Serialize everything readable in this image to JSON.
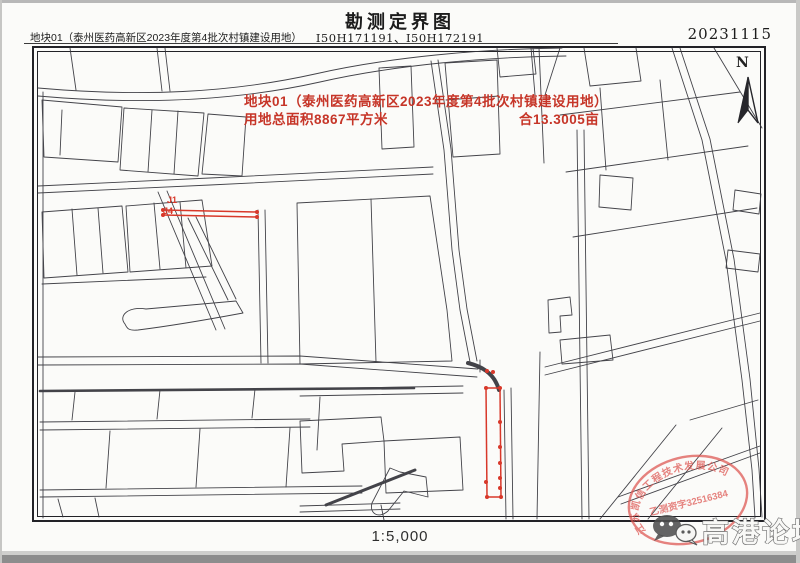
{
  "page": {
    "title": "勘测定界图",
    "header_left": "地块01（泰州医药高新区2023年度第4批次村镇建设用地）",
    "sheet_codes": "I50H171191、I50H172191",
    "date": "20231115",
    "scale": "1:5,000",
    "north_label": "N"
  },
  "annotation": {
    "line1": "地块01（泰州医药高新区2023年度第4批次村镇建设用地）",
    "line2a": "用地总面积8867平方米",
    "line2b": "合13.3005亩"
  },
  "point_labels": {
    "j1": "J1",
    "j4": "J4"
  },
  "stamp": {
    "arc_text": "江苏凯信工程技术发展公司",
    "center_text": "乙测资字32516384"
  },
  "watermark": {
    "text": "高港论坛"
  },
  "colors": {
    "line": "#34343b",
    "red": "#d8382a",
    "annotation_red": "#c63528",
    "seal_red": "#dd5450",
    "watermark_gray": "#707070"
  },
  "map_geometry": {
    "parcel_paths": [
      "M38,88 C140,97 230,93 315,74 C390,57 480,49 562,48",
      "M38,96 C140,105 235,101 320,82 C395,65 485,57 566,56",
      "M157,48 L162,91",
      "M165,48 L170,91",
      "M70,48 L76,90",
      "M431,61 L444,150 L452,250 L460,310 L470,362",
      "M438,60 L451,149 L459,250 L467,309 L477,361",
      "M497,48 L500,77 L536,74 L533,48",
      "M531,48 L535,95",
      "M539,48 L544,163",
      "M672,48 L702,140 L726,260 L742,380 L752,470 L755,518",
      "M680,48 L710,139 L734,259 L750,379 L759,469 L762,517",
      "M584,48 L590,86 L641,81 L636,48",
      "M560,115 L740,92",
      "M566,172 L748,146",
      "M573,237 L757,208",
      "M600,88 L606,170",
      "M660,80 L668,160",
      "M714,48 L762,128",
      "M735,190 L761,194 L759,214 L733,210 Z",
      "M728,250 L760,254 L758,272 L726,268 Z",
      "M38,186 L210,178 L433,167",
      "M38,193 L210,185 L433,174",
      "M42,100 L122,107 L118,162 L44,157 Z",
      "M62,110 L60,155",
      "M124,108 L204,113 L198,176 L120,170 Z",
      "M152,110 L148,172",
      "M178,111 L174,174",
      "M208,114 L246,117 L242,176 L202,174 Z",
      "M42,212 L122,206 L128,272 L44,278 Z",
      "M72,209 L77,275",
      "M98,208 L103,273",
      "M126,206 L202,200 L212,266 L130,272 Z",
      "M154,203 L160,269",
      "M180,202 L186,268",
      "M158,192 L216,330",
      "M167,191 L225,329",
      "M188,218 L228,300",
      "M196,217 L236,299",
      "M125,324 C118,316 128,306 146,309 L236,301 L243,313 C200,321 162,327 138,330 C128,331 127,328 125,324 Z",
      "M42,284 L206,277",
      "M258,210 L261,363",
      "M265,210 L268,363",
      "M297,203 L430,196 L447,310 L452,361 L300,364 Z",
      "M371,199 L376,362",
      "M379,68 L411,66 L414,147 L382,149 Z",
      "M445,63 L497,60 L500,154 L453,157 Z",
      "M446,100 L499,96",
      "M38,357 L300,356 L478,369",
      "M38,365 L300,364 L477,377",
      {
        "d": "M40,391 L414,388",
        "w": 2.6
      },
      "M40,422 L310,419",
      "M40,430 L310,427",
      "M75,392 L72,420",
      "M160,390 L157,419",
      "M255,389 L252,418",
      "M110,431 L106,488",
      "M200,429 L196,487",
      "M290,428 L286,487",
      "M40,490 L362,486",
      "M40,497 L362,493",
      "M58,499 L63,517",
      "M95,498 L99,517",
      {
        "d": "M326,505 L415,470",
        "w": 3
      },
      "M390,468 L372,503 C369,514 379,519 388,511 L404,491 L428,497 L426,477 L400,472 Z",
      "M300,389 L463,386",
      "M300,396 L463,393",
      "M320,397 L317,450",
      "M300,421 L381,417 L384,441 L342,444 L344,471 L302,473 Z",
      "M384,441 L460,437 L463,490 L386,493 Z",
      "M300,506 L400,503",
      "M300,512 L400,509",
      "M381,505 L384,520",
      "M504,390 L506,519",
      "M511,388 L513,519",
      "M540,352 L537,519",
      "M577,130 L582,519",
      "M584,130 L589,519",
      "M545,367 L760,313",
      "M545,375 L760,321",
      "M618,497 L760,446",
      "M621,504 L760,453",
      "M600,519 L676,425",
      "M648,519 L722,428",
      "M690,420 L758,400",
      "M600,175 L633,178 L631,210 L599,207 Z",
      "M545,95 L560,48",
      "M43,92 L43,518",
      "M548,300 L570,297 L572,315 L560,316 L561,332 L549,333 Z",
      "M560,340 L610,335 L613,360 L562,364 Z",
      "M480,360 L480,372",
      {
        "d": "M468,363 C480,366 494,372 499,390",
        "w": 4
      }
    ],
    "red_paths": [
      "M163,210 L257,212",
      "M163,215 L257,217",
      "M486,388 L500,388",
      "M486,388 L487,497",
      "M500,388 L501,497",
      "M487,497 L501,497"
    ],
    "red_dots": [
      [
        163,
        210
      ],
      [
        163,
        215
      ],
      [
        257,
        212
      ],
      [
        257,
        217
      ],
      [
        486,
        388
      ],
      [
        500,
        388
      ],
      [
        500,
        422
      ],
      [
        500,
        447
      ],
      [
        500,
        463
      ],
      [
        500,
        478
      ],
      [
        500,
        488
      ],
      [
        501,
        497
      ],
      [
        487,
        497
      ],
      [
        486,
        482
      ],
      [
        487,
        371
      ],
      [
        493,
        372
      ]
    ]
  }
}
